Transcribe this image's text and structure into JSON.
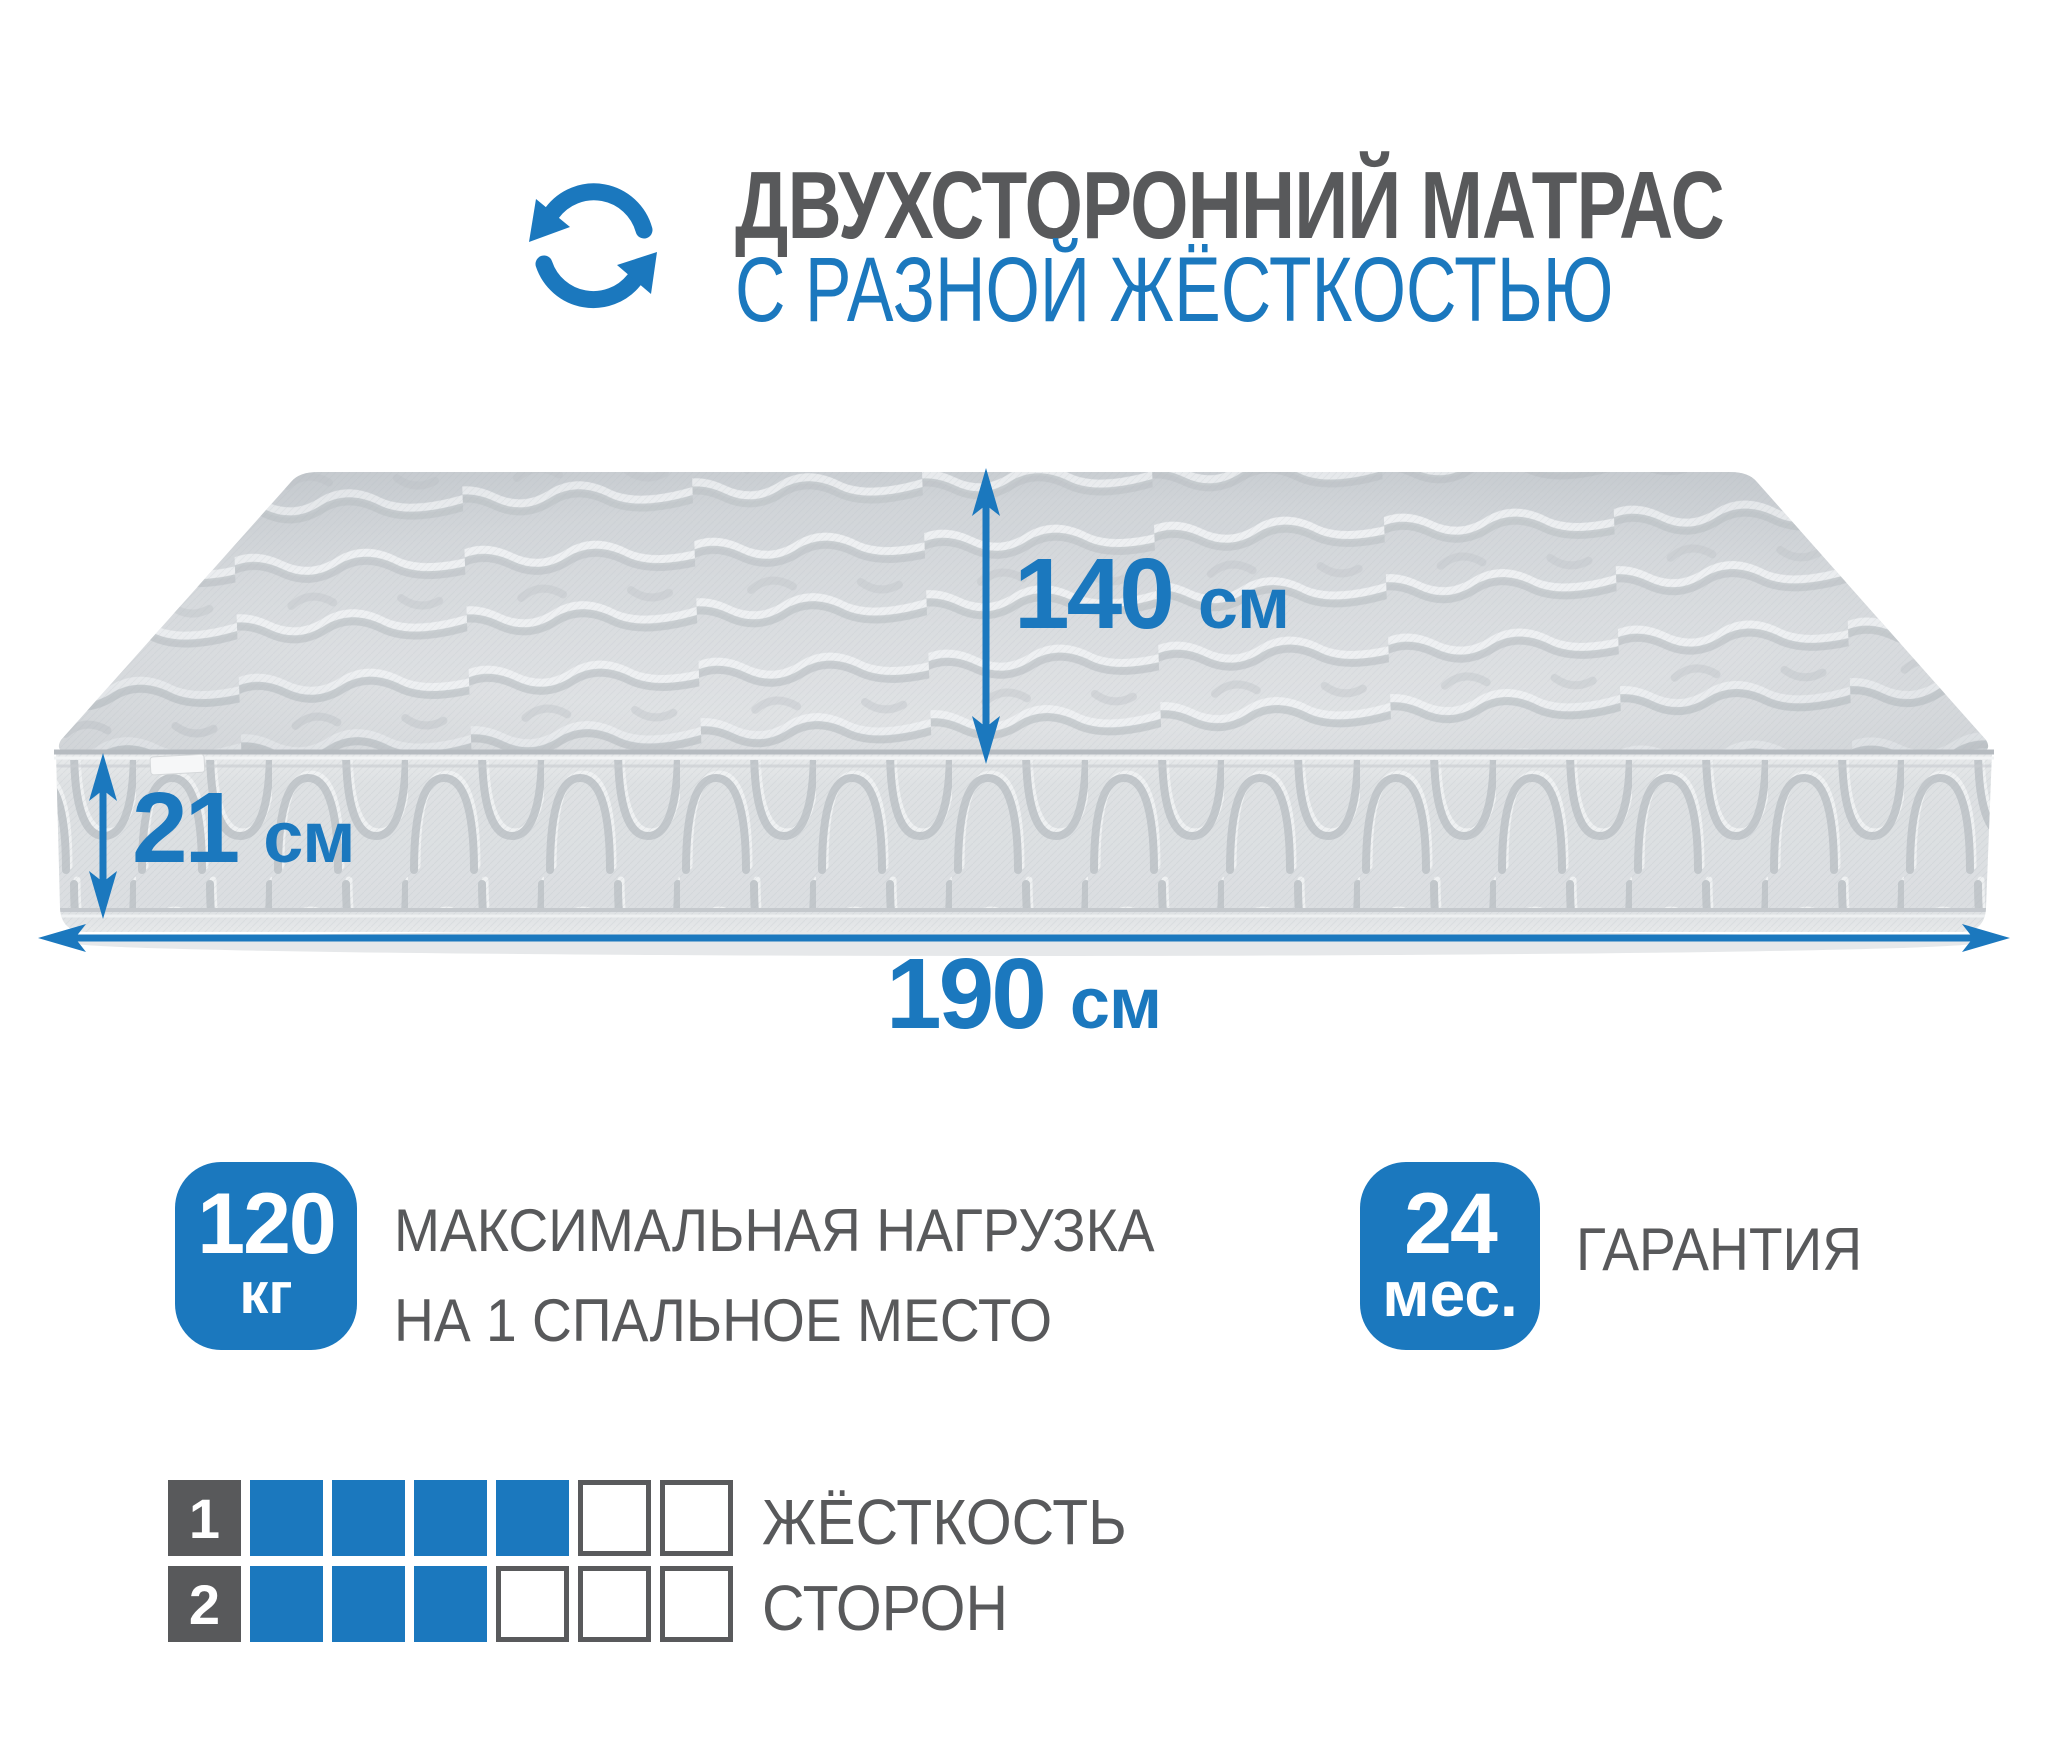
{
  "colors": {
    "accent_blue": "#1B78BE",
    "text_gray": "#58595B",
    "mattress_light": "#dcdfe2",
    "mattress_shadow": "#c3c8cc"
  },
  "header": {
    "icon": "rotate-arrows-icon",
    "title_line1": "ДВУХСТОРОННИЙ МАТРАС",
    "title_line2": "С РАЗНОЙ ЖЁСТКОСТЬЮ"
  },
  "dimensions": {
    "width": {
      "value": "140",
      "unit": "см"
    },
    "height": {
      "value": "21",
      "unit": "см"
    },
    "length": {
      "value": "190",
      "unit": "см"
    }
  },
  "max_load": {
    "value": "120",
    "unit": "кг",
    "label_line1": "МАКСИМАЛЬНАЯ НАГРУЗКА",
    "label_line2": "НА 1 СПАЛЬНОЕ МЕСТО"
  },
  "warranty": {
    "value": "24",
    "unit": "мес.",
    "label": "ГАРАНТИЯ"
  },
  "firmness": {
    "label_line1": "ЖЁСТКОСТЬ",
    "label_line2": "СТОРОН",
    "scale_max": 6,
    "rows": [
      {
        "number": "1",
        "filled": 4
      },
      {
        "number": "2",
        "filled": 3
      }
    ]
  }
}
